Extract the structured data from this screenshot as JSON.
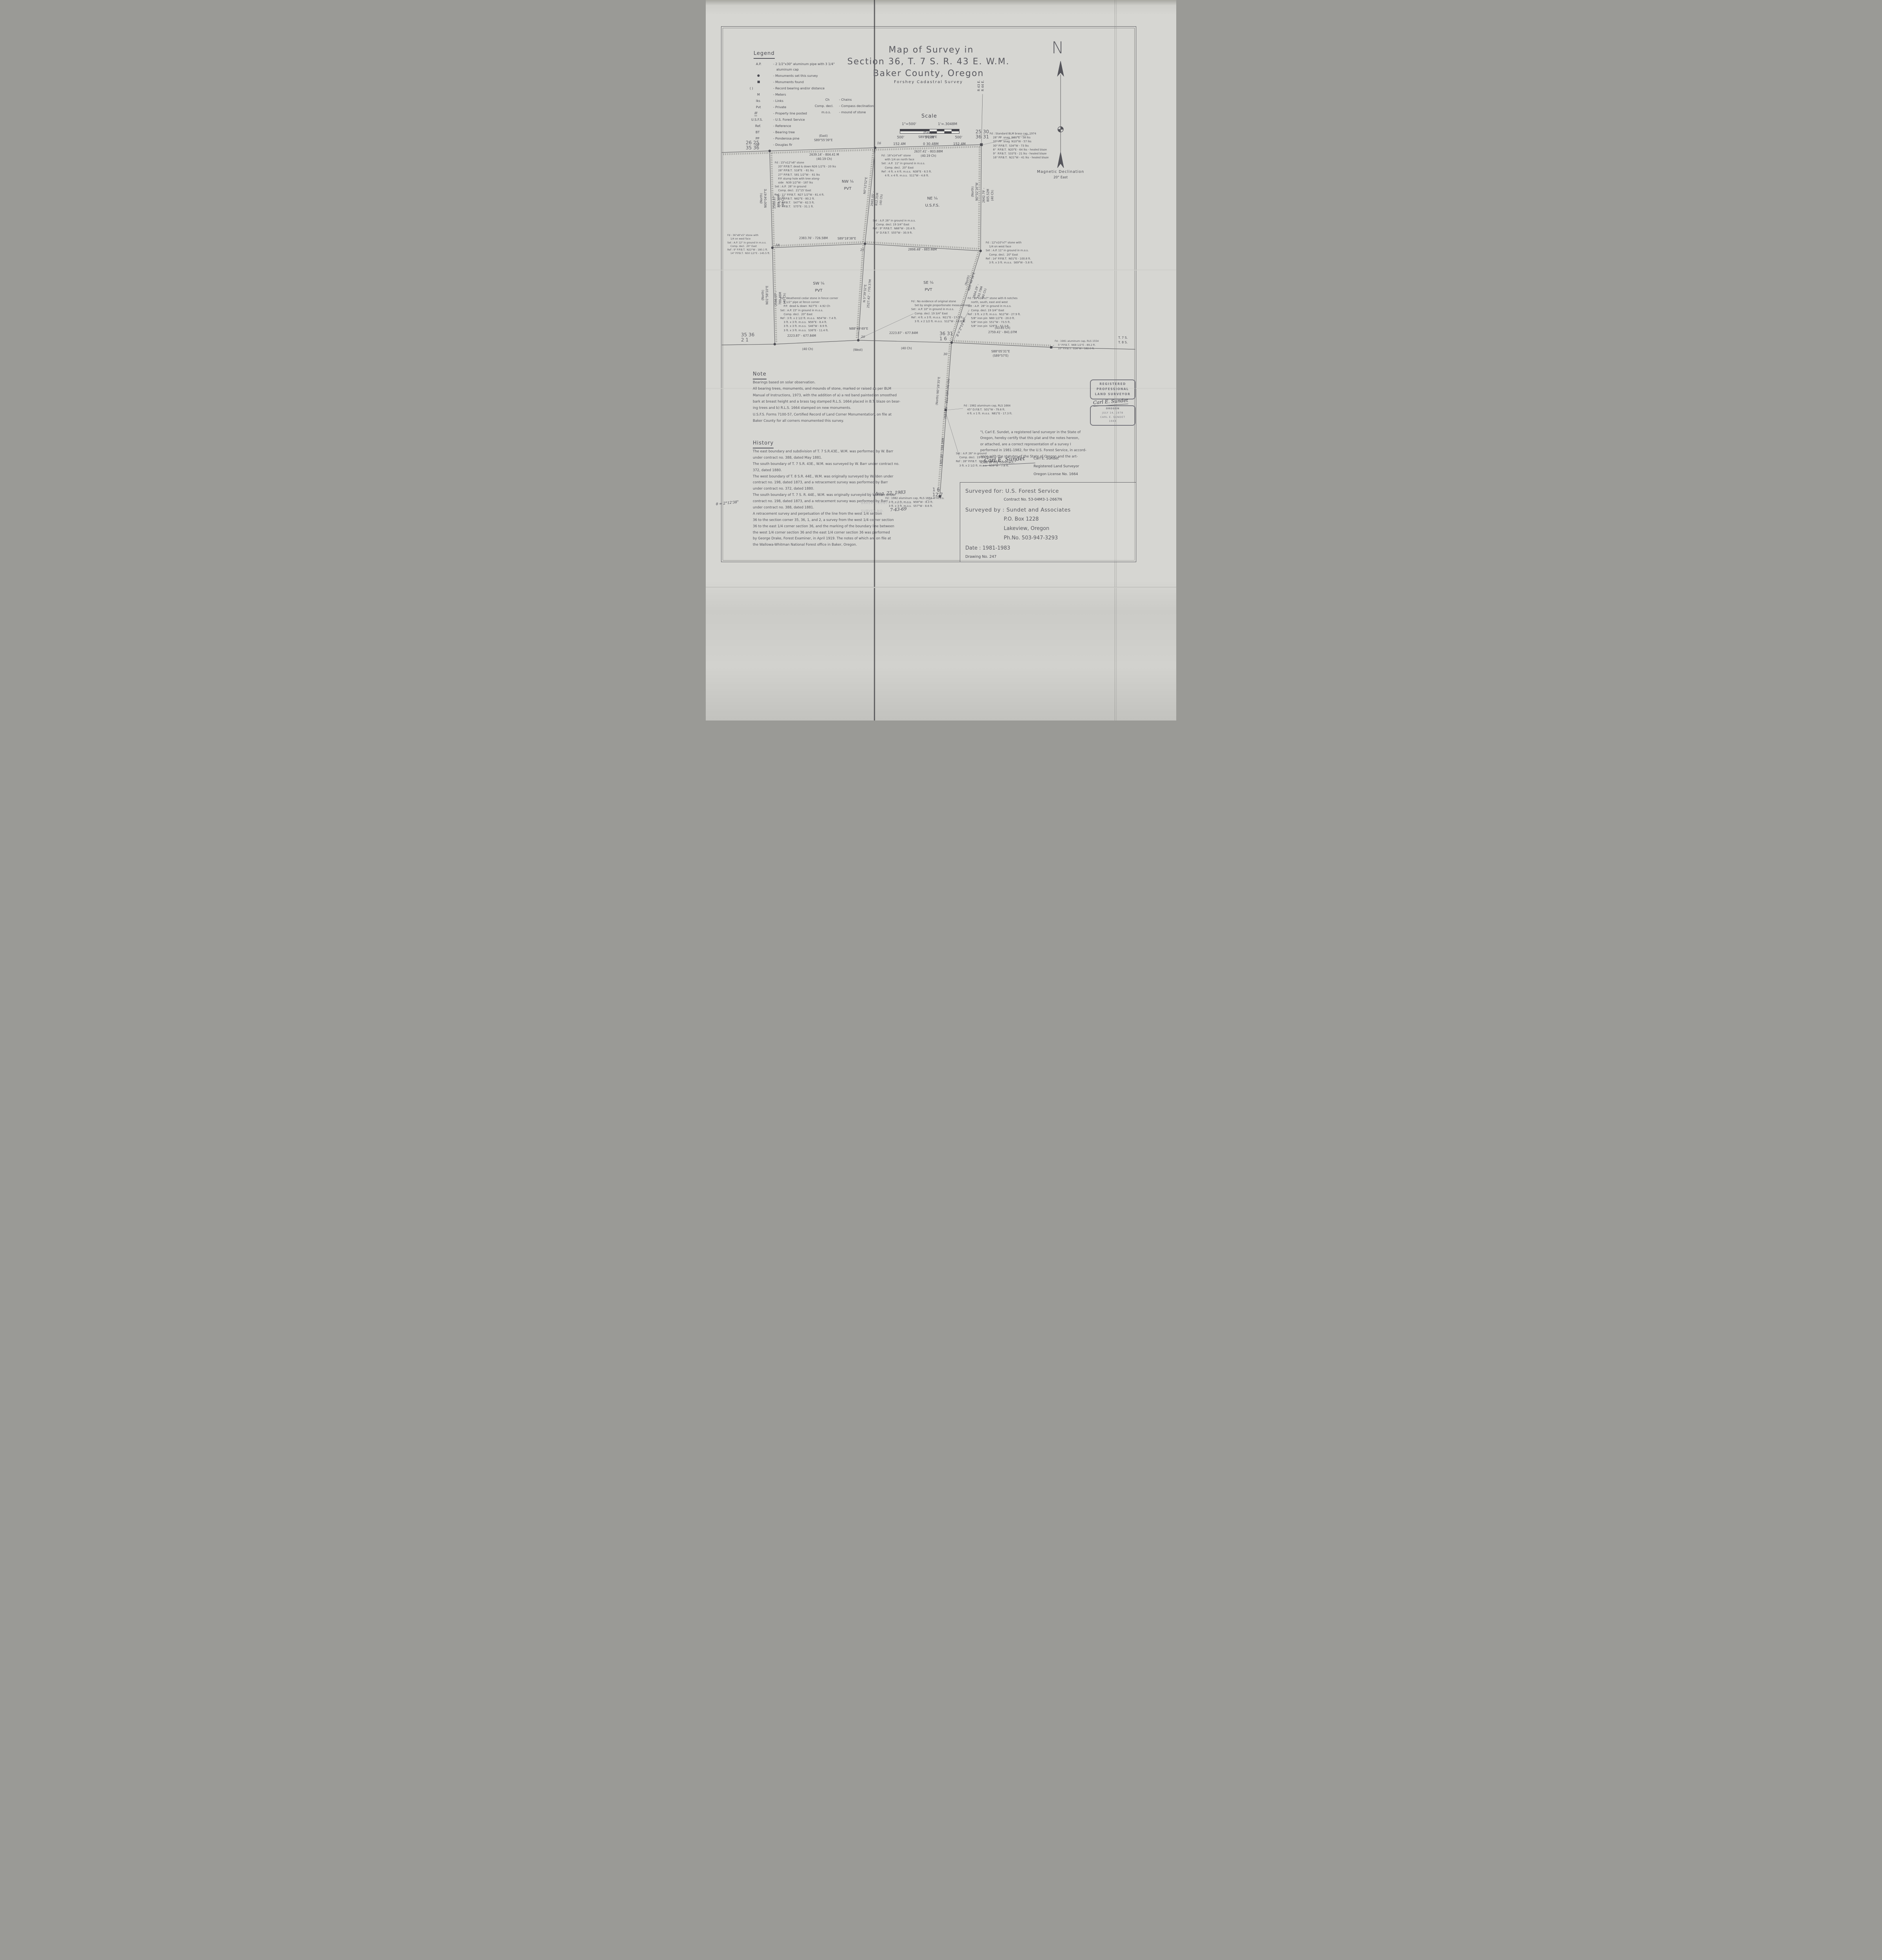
{
  "legend": {
    "title": "Legend",
    "items": [
      {
        "abbr": "A.P.",
        "desc": "- 2 1/2\"x30\" aluminum pipe with 3 1/4\""
      },
      {
        "abbr": "",
        "desc": "aluminum cap"
      },
      {
        "abbr": "●",
        "desc": "- Monuments set this survey"
      },
      {
        "abbr": "■",
        "desc": "- Monuments found"
      },
      {
        "abbr": "(      )",
        "desc": "- Record bearing and/or distance"
      },
      {
        "abbr": "M",
        "desc": "- Meters"
      },
      {
        "abbr": "lks",
        "desc": "- Links"
      },
      {
        "abbr": "Pvt",
        "desc": "- Private"
      },
      {
        "abbr": "////",
        "desc": "- Property line posted"
      },
      {
        "abbr": "U.S.F.S.",
        "desc": "- U.S. Forest Service"
      },
      {
        "abbr": "Ref.",
        "desc": "- Reference"
      },
      {
        "abbr": "BT",
        "desc": "- Bearing tree"
      },
      {
        "abbr": "PP",
        "desc": "- Ponderosa pine"
      },
      {
        "abbr": "DF",
        "desc": "- Douglas fir"
      }
    ],
    "col2": [
      {
        "abbr": "Ch",
        "desc": "- Chains"
      },
      {
        "abbr": "Comp. decl.",
        "desc": "- Compass declination"
      },
      {
        "abbr": "m.o.s.",
        "desc": "- mound of stone"
      }
    ]
  },
  "title": {
    "line1": "Map of Survey in",
    "line2": "Section 36, T. 7 S. R. 43 E. W.M.",
    "line3": "Baker County, Oregon",
    "subtitle": "Forshey Cadastral Survey"
  },
  "scalebar": {
    "heading": "Scale",
    "ratio_left": "1\"=500'",
    "ratio_right": "1'=.3048M",
    "t1": "500'",
    "t2": "0'100'",
    "t3": "500'",
    "m1": "152.4M",
    "m2": "0 30.48M",
    "m3": "152.4M"
  },
  "compass": {
    "n": "N",
    "label1": "Magnetic Declination",
    "label2": "20° East"
  },
  "map": {
    "corner_numbers": {
      "nw": "26  25\n35  36",
      "ne": "25  30\n36  31",
      "se": "36  31\n1    6",
      "sw": "35  36\n2    1",
      "ext": "1    6\n12   7"
    },
    "range_labels": {
      "r": "R 43 E.\nR 44 E.",
      "t": "T. 7 S.\nT. 8 S."
    },
    "quarters": {
      "nw": "NW ¼\nPVT",
      "ne": "NE ¼\nU.S.F.S.",
      "sw": "SW ¼\nPVT",
      "se": "SE ¼\nPVT"
    },
    "line_labels": {
      "nlw_b": "(East)\nS89°55'39\"E",
      "nlw_d": "2639.14' - 804.41 M\n(40.19 Ch)",
      "nle_b": "(East)\nS89°50'29\"E",
      "nle_d": "2637.41' - 803.88M\n(40.19 Ch)",
      "wln_b": "(North)\nN00°04'47\"E",
      "wln_d": "2589.87' - 789.39M\n(40 Ch)",
      "wls_b": "(North)\nN01°58'10\"E",
      "wls_d": "2590.07' - 789.46M\n(40 Ch)",
      "cnn_b": "N0°12'52\"E",
      "cnn_d": "2665.05' - 812.31M\n(40 Ch)",
      "eln_b": "(North)\nN0°02'16\"W",
      "eln_d": "2642.79' - 805.52M\n(40 Ch)",
      "ed_b": "(North)\nN20°46'58\"E",
      "ed_d": "2604.29' - 793.79M\n(40 Ch)",
      "cs_b": "N 5°39'32\"E\n2527.42' - 770.37M",
      "mid1_d": "2383.76' - 726.58M",
      "mid1_b": "S89°18'38\"E",
      "mid2_d": "2898.48' - 883.46M",
      "s1_d": "2223.87' - 677.84M",
      "s1_c": "(40 Ch)",
      "s_b": "N88°49'49\"E",
      "s_w": "(West)",
      "s2_d": "2223.87' - 677.84M",
      "s2_c": "(40 Ch)",
      "se_c": "(43.85 Ch)\n2759.41' - 841.07M",
      "se_b": "S88°05'31\"E\n(S89°57'E)",
      "ext_b": "(North)  N0°28'35\"E",
      "ext_d": "2665.65' - 812.49M  (40 Ch)",
      "ext2": "1305.89' - 398.04M"
    },
    "notes": {
      "nw": "Fd : 15\"x12\"x6\" stone\n    20\" P.P.B.T. dead & down N26 1/2°E - 20 lks\n    28\" P.P.B.T.  S18°E  - 61 lks\n    27\" P.P.B.T.  S81 1/2°W -  61 lks\n    P.P. stump hole with tree along-\n    side   N39 1/2°W - 187 lks\nSet : A.P.  26\" in ground\n    Comp. decl.  21°15' East\nRef : 11\" P.P.B.T.  N27 1/2°W - 61.4 ft.\n    11\" P.P.B.T.  N62°E - 80.2 ft.\n    8\" P.P.B.T.   S47°W - 62.5 ft.\n    6\" P.P.B.T.   S75°E - 31.1 ft.",
      "n4": "Fd : 16\"x14\"x4\" stone\n    with 1/4 on north face\nSet : A.P.  11\" in ground in m.o.s.\n    Comp. decl.  20° East\nRef : 4 ft. x 4 ft. m.o.s.  N38°E - 6.5 ft.\n    4 ft. x 4 ft. m.o.s.  S11°W - 4.8 ft.",
      "ne": "Fd : Standard BLM brass cap, 1974\n    28\" PP  snag  N61°E - 58 lks\n    37\" PP  snag  N10°W - 57 lks\n    30\" P.P.B.T.  S34°W - 73 lks\n    6\"  P.P.B.T.  N20°E - 64 lks - healed blaze\n    9\"  P.P.B.T.  S33°E - 21 lks - healed blaze\n    16\" P.P.B.T.  N21°W - 41 lks - healed blaze",
      "w4": "Fd : 36\"x8\"x5\" stone with\n    1/4 on west face\nSet : A.P. 12\" in ground in m.o.s.\n    Comp. decl.  20° East\nRef : 9\" P.P.B.T.  N22°W - 180.1 ft.\n    14\" P.P.B.T.  N50 1/2°E - 145.5 ft.",
      "center": "Set : A.P. 26\" in ground in m.o.s.\n    Comp. decl. 19 3/4° East\nRef : 9\" P.P.B.T.  N66°W - 20.4 ft.\n    9\" D.F.B.T.  S55°W - 30.9 ft.",
      "e4": "Fd : 12\"x10\"x7\" stone with\n    1/4 on west face\nSet : A.P. 11\" in ground in m.o.s.\n    Comp. decl.  20° East\nRef : 14\" P.P.B.T.  N01°E - 100.8 ft.\n    3 ft. x 3 ft. m.o.s.  S69°W - 5.8 ft.",
      "sw": "Fd : Weathered cedar stone in fence corner\n    1 1/2\" pipe at fence corner\n    P.P.  dead & down  N27°E - 4.92 Ch\nSet : A.P. 15\" in ground in m.o.s.\n    Comp. decl.  20° East\nRef : 3 ft. x 2 1/2 ft. m.o.s.  N54°W - 7.4 ft.\n    3 ft. x 3 ft. m.o.s.  N56°E - 8.4 ft.\n    3 ft. x 3 ft. m.o.s.  S46°W - 8.9 ft.\n    3 ft. x 3 ft. m.o.s.  S36°E - 11.4 ft.",
      "s4": "Fd : No evidence of original stone\n    Set by single proportionate measurement\nSet : A.P. 10\" in ground in m.o.s.\n    Comp. decl. 19 3/4° East\nRef : 4 ft. x 3 ft. m.o.s.  N11°E - 17.3 ft.\n    3 ft. x 2 1/2 ft. m.o.s.  S12°W - 10.6 ft.",
      "se6": "Fd : 16\"x10\"x7\" stone with 6 notches\n    north, south, east and west\nSet : A.P.  26\" in ground in m.o.s.\n    Comp. decl. 19 3/4° East\nRef : 3 ft. x 2 ft. m.o.s.  N12°W - 27.9 ft.\n    5/8\" iron pin  N60 1/2°E - 20.0 ft.\n    5/8\" iron pin  S51°W - 73.5 ft.\n    5/8\" iron pin  S29°E - 57.3 ft.",
      "set26": "Set : A.P. 26\" in ground\n    Comp. decl.  19 3/4° East\nRef : 28\" P.P.B.T.  S50°E - 183.4 ft.\n    3 ft. x 2 1/2 ft. m.o.s.  N59°W - 7.8 ft.",
      "f82mid": "Fd : 1982 aluminum cap, RLS 1664\n    45\" D.F.B.T.  S01°W - 79.6 ft.\n    4 ft. x 1 ft. m.o.s.  N81°E - 17.3 ft.",
      "f82low": "Fd : 1982 aluminum cap, RLS 1664 in m.o.s.\n    3 ft. x 2 ft. m.o.s.  N58°W - 8.3 ft.\n    3 ft. x 3 ft. m.o.s.  S57°W - 8.6 ft.",
      "f81": "Fd : 1981 aluminum cap, RLS 1554\n    5\" P.P.B.T.  N68 1/2°E - 89.2 ft.\n    10\" P.P.B.T.  S16°W - 182.0 ft."
    },
    "handwritten": {
      "n16": "16",
      "w18": "18",
      "s20": "20",
      "c21": "21",
      "se30": "30",
      "theta_se": "θ = 2°12'40\"",
      "theta_margin": "θ = 2°12'38\""
    }
  },
  "note_section": {
    "title": "Note",
    "body": "Bearings based on solar observation.\nAll bearing trees, monuments, and mounds of stone, marked or raised as per BLM\nManual of Instructions, 1973, with the addition of a) a red band painted on smoothed\nbark at breast height and a brass tag stamped R.L.S. 1664 placed in B.T. blaze on bear-\ning trees and b) R.L.S. 1664 stamped on new monuments.\nU.S.F.S. Forms 7100-57, Certified Record of Land Corner Monumentation, on file at\nBaker County for all corners monumented this survey."
  },
  "history_section": {
    "title": "History",
    "body": "The east boundary and subdivision of T. 7 S.R.43E., W.M. was performed by W. Barr\nunder contract no. 388, dated May 1881.\nThe south boundary of T. 7 S.R. 43E., W.M. was surveyed by W. Barr under contract no.\n372, dated 1880.\nThe west boundary of T. 8 S.R. 44E., W.M. was originally surveyed by Walden under\ncontract no. 198, dated 1873, and a retracement survey was performed by Barr\nunder contract no. 372, dated 1880.\nThe south boundary of T. 7 S. R. 44E., W.M. was originally surveyed by Walden under\ncontract no. 198, dated 1873, and a retracement survey was performed by Barr\nunder contract no. 388, dated 1881.\nA retracement survey and perpetuation of the line from the west 1/4 section\n36 to the section corner 35, 36, 1, and 2, a survey from the west 1/4 corner section\n36 to the east 1/4 corner section 36, and the marking of the boundary line between\nthe west 1/4 corner section 36 and the east 1/4 corner section 36 was performed\nby George Drake, Forest Examiner, in April 1919. The notes of which are on file at\nthe Wallowa-Whitman National Forest office in Baker, Oregon."
  },
  "certification": {
    "body": "\"I, Carl E. Sundet, a registered land surveyor in the State of\nOregon, hereby certify that this plat and the notes hereon,\nor attached, are a correct representation of a survey I\nperformed in 1981-1982, for the U.S. Forest Service, in accord-\nance with the statutes of the State of Oregon and the art-\nicles of my contract.\"",
    "signature": "Carl E. Sundet",
    "name": "Carl  E. Sundet",
    "role": "Registered Land Surveyor",
    "license": "Oregon License No. 1664"
  },
  "stamp": {
    "l1": "REGISTERED",
    "l2": "PROFESSIONAL",
    "l3": "LAND SURVEYOR",
    "sig": "Carl E. Sundet",
    "b1": "OREGON",
    "b2": "JULY 14, 1978",
    "b3": "CARL E. SUNDET",
    "b4": "1664"
  },
  "titleblock": {
    "for_label": "Surveyed for: U.S. Forest Service",
    "contract": "Contract No. 53-04M3-1-2667N",
    "by_label": "Surveyed by : Sundet and Associates",
    "addr1": "P.O. Box 1228",
    "addr2": "Lakeview, Oregon",
    "phone": "Ph.No. 503-947-3293",
    "date": "Date            : 1981-1983",
    "drawing": "Drawing No.  247"
  },
  "filing": {
    "stamp1": "FILED",
    "stamp2": "BAKER COUNTY SURVEYOR",
    "stamp3": "SURVEY NO.",
    "date_hw": "Aug. 22, 1983",
    "survey_no_hw": "7-43-69"
  }
}
